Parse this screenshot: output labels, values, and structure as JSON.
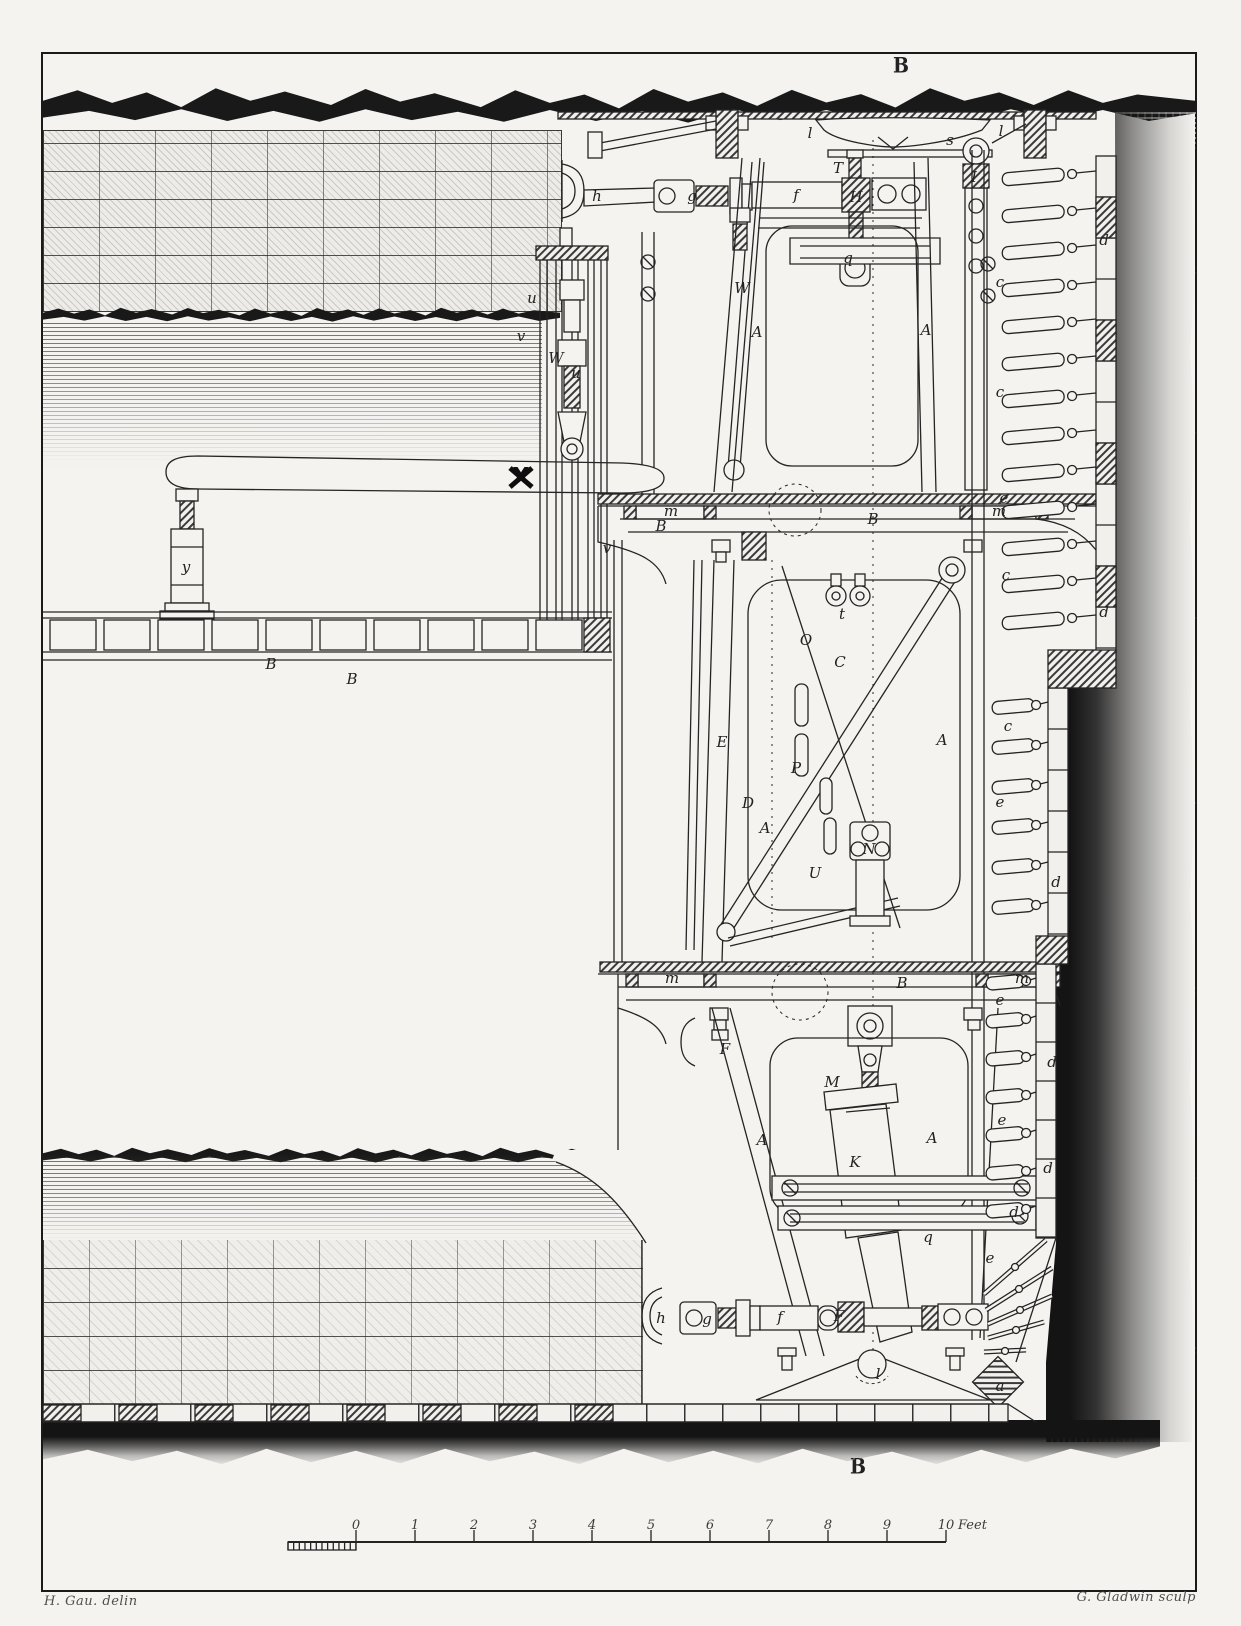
{
  "plate": {
    "top_mark": "B",
    "bottom_mark": "B",
    "credit_left": "H. Gau. delin",
    "credit_right": "G. Gladwin sculp"
  },
  "scale_bar": {
    "unit_label": "Feet",
    "ticks": [
      "0",
      "1",
      "2",
      "3",
      "4",
      "5",
      "6",
      "7",
      "8",
      "9",
      "10"
    ]
  },
  "colors": {
    "paper": "#f3f2ef",
    "ink": "#1c1c1c"
  },
  "labels": [
    {
      "t": "h",
      "x": 597,
      "y": 196
    },
    {
      "t": "g",
      "x": 692,
      "y": 196
    },
    {
      "t": "f",
      "x": 796,
      "y": 195
    },
    {
      "t": "H",
      "x": 856,
      "y": 197
    },
    {
      "t": "l",
      "x": 810,
      "y": 133
    },
    {
      "t": "s",
      "x": 950,
      "y": 140
    },
    {
      "t": "l",
      "x": 1001,
      "y": 131
    },
    {
      "t": "T",
      "x": 838,
      "y": 168
    },
    {
      "t": "I",
      "x": 974,
      "y": 177
    },
    {
      "t": "q",
      "x": 848,
      "y": 258
    },
    {
      "t": "W",
      "x": 742,
      "y": 288
    },
    {
      "t": "A",
      "x": 757,
      "y": 332
    },
    {
      "t": "A",
      "x": 926,
      "y": 330
    },
    {
      "t": "u",
      "x": 532,
      "y": 298
    },
    {
      "t": "v",
      "x": 521,
      "y": 336
    },
    {
      "t": "W",
      "x": 556,
      "y": 358
    },
    {
      "t": "u",
      "x": 576,
      "y": 373
    },
    {
      "t": "X",
      "x": 521,
      "y": 477,
      "cls": "bigx"
    },
    {
      "t": "v",
      "x": 607,
      "y": 548
    },
    {
      "t": "y",
      "x": 186,
      "y": 567
    },
    {
      "t": "B",
      "x": 271,
      "y": 664
    },
    {
      "t": "B",
      "x": 352,
      "y": 679
    },
    {
      "t": "m",
      "x": 671,
      "y": 511
    },
    {
      "t": "B",
      "x": 661,
      "y": 526
    },
    {
      "t": "B",
      "x": 873,
      "y": 519
    },
    {
      "t": "m",
      "x": 999,
      "y": 511
    },
    {
      "t": "E",
      "x": 722,
      "y": 742
    },
    {
      "t": "D",
      "x": 748,
      "y": 803
    },
    {
      "t": "O",
      "x": 806,
      "y": 640
    },
    {
      "t": "C",
      "x": 840,
      "y": 662
    },
    {
      "t": "t",
      "x": 842,
      "y": 614
    },
    {
      "t": "P",
      "x": 796,
      "y": 768
    },
    {
      "t": "U",
      "x": 815,
      "y": 873
    },
    {
      "t": "A",
      "x": 765,
      "y": 828
    },
    {
      "t": "A",
      "x": 942,
      "y": 740
    },
    {
      "t": "N",
      "x": 869,
      "y": 849
    },
    {
      "t": "m",
      "x": 672,
      "y": 978
    },
    {
      "t": "B",
      "x": 902,
      "y": 983
    },
    {
      "t": "m",
      "x": 1022,
      "y": 978
    },
    {
      "t": "F",
      "x": 725,
      "y": 1049
    },
    {
      "t": "M",
      "x": 832,
      "y": 1082
    },
    {
      "t": "K",
      "x": 855,
      "y": 1162
    },
    {
      "t": "A",
      "x": 762,
      "y": 1140
    },
    {
      "t": "A",
      "x": 932,
      "y": 1138
    },
    {
      "t": "q",
      "x": 928,
      "y": 1237
    },
    {
      "t": "h",
      "x": 661,
      "y": 1318
    },
    {
      "t": "g",
      "x": 707,
      "y": 1319
    },
    {
      "t": "f",
      "x": 780,
      "y": 1317
    },
    {
      "t": "F",
      "x": 839,
      "y": 1316
    },
    {
      "t": "l",
      "x": 878,
      "y": 1374
    },
    {
      "t": "a",
      "x": 1000,
      "y": 1386
    },
    {
      "t": "d",
      "x": 1104,
      "y": 240
    },
    {
      "t": "c",
      "x": 1000,
      "y": 282
    },
    {
      "t": "c",
      "x": 1000,
      "y": 392
    },
    {
      "t": "e",
      "x": 1004,
      "y": 498
    },
    {
      "t": "c",
      "x": 1006,
      "y": 575
    },
    {
      "t": "d",
      "x": 1104,
      "y": 612
    },
    {
      "t": "c",
      "x": 1008,
      "y": 726
    },
    {
      "t": "e",
      "x": 1000,
      "y": 802
    },
    {
      "t": "d",
      "x": 1056,
      "y": 882
    },
    {
      "t": "e",
      "x": 1000,
      "y": 1000
    },
    {
      "t": "d",
      "x": 1052,
      "y": 1062
    },
    {
      "t": "e",
      "x": 1002,
      "y": 1120
    },
    {
      "t": "d",
      "x": 1048,
      "y": 1168
    },
    {
      "t": "d",
      "x": 1014,
      "y": 1212
    },
    {
      "t": "e",
      "x": 990,
      "y": 1258
    }
  ]
}
